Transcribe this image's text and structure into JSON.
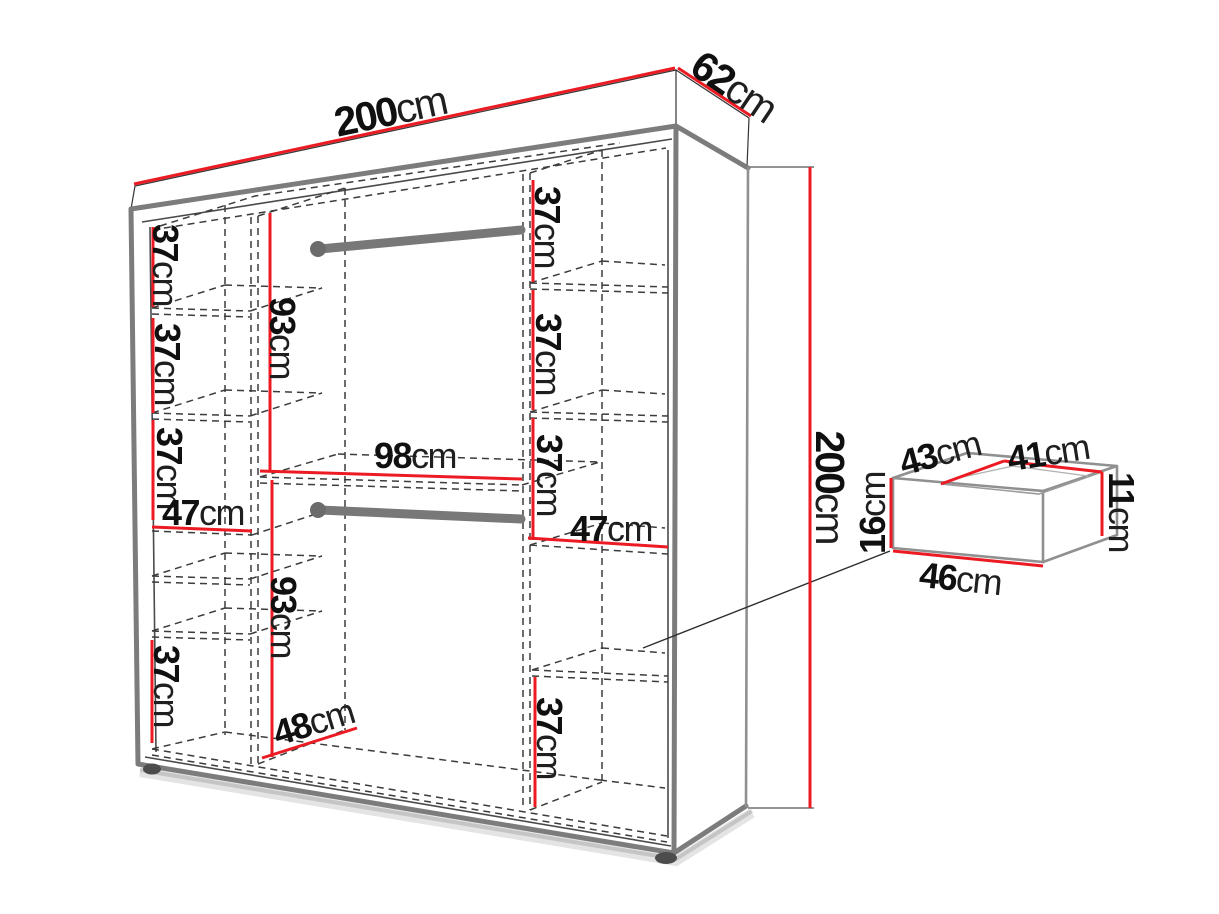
{
  "meta": {
    "type": "furniture-dimension-diagram",
    "subject": "sliding-door wardrobe interior layout with drawer detail"
  },
  "colors": {
    "dimension_red": "#ec1b23",
    "edge_gray": "#7c7c7c",
    "hidden_line": "#3c3c3c",
    "label_text": "#101010",
    "background": "#ffffff"
  },
  "wardrobe": {
    "overall": {
      "width": {
        "value": "200",
        "unit": "cm"
      },
      "depth": {
        "value": "62",
        "unit": "cm"
      },
      "height": {
        "value": "200",
        "unit": "cm"
      }
    },
    "left_column": {
      "sections": [
        {
          "value": "37",
          "unit": "cm"
        },
        {
          "value": "37",
          "unit": "cm"
        },
        {
          "value": "37",
          "unit": "cm"
        }
      ],
      "shelf_width": {
        "value": "47",
        "unit": "cm"
      },
      "bottom_section": {
        "value": "37",
        "unit": "cm"
      }
    },
    "center_column": {
      "hanging_sections": [
        {
          "value": "93",
          "unit": "cm"
        },
        {
          "value": "93",
          "unit": "cm"
        }
      ],
      "shelf_width": {
        "value": "98",
        "unit": "cm"
      },
      "floor_depth": {
        "value": "48",
        "unit": "cm"
      }
    },
    "right_column": {
      "sections": [
        {
          "value": "37",
          "unit": "cm"
        },
        {
          "value": "37",
          "unit": "cm"
        },
        {
          "value": "37",
          "unit": "cm"
        }
      ],
      "shelf_width": {
        "value": "47",
        "unit": "cm"
      },
      "bottom_section": {
        "value": "37",
        "unit": "cm"
      }
    }
  },
  "drawer": {
    "top_depth": {
      "value": "43",
      "unit": "cm"
    },
    "top_width": {
      "value": "41",
      "unit": "cm"
    },
    "front_height": {
      "value": "16",
      "unit": "cm"
    },
    "inner_height": {
      "value": "11",
      "unit": "cm"
    },
    "bottom_width": {
      "value": "46",
      "unit": "cm"
    }
  }
}
